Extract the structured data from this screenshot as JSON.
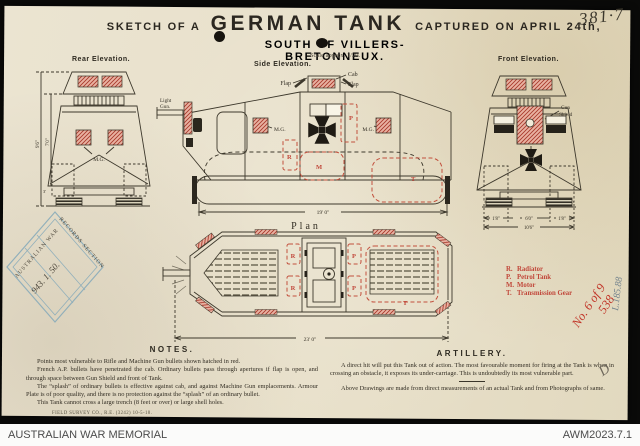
{
  "title": {
    "prefix": "SKETCH OF A",
    "main": "GERMAN TANK",
    "suffix": "CAPTURED ON APRIL 24th,",
    "line2": "SOUTH OF VILLERS-BRETONNEUX.",
    "scale": "Scale approx. 1/20."
  },
  "handwriting": {
    "top_right_number": "381·7",
    "blue_vertical": "L.185.88",
    "red_script_line1": "No. 6 of 9",
    "red_script_line2": "538",
    "pencil_letter": "D"
  },
  "stamp": {
    "arc_top": "AUSTRALIAN WAR",
    "arc_bottom": "RECORDS SECTION",
    "number": "943. 1. 50."
  },
  "rear": {
    "label": "Rear Elevation.",
    "mg": "M.G.",
    "dim_overall": "9'6\"",
    "dim_body": "7'0\"",
    "dim_bottom": "3'"
  },
  "side": {
    "label": "Side Elevation.",
    "cab": "Cab",
    "flap_left": "Flap",
    "flap_right": "Flap",
    "light_gun_1": "Light",
    "light_gun_2": "Gun.",
    "mg_left": "M.G.",
    "mg_right": "M.G.",
    "p": "P",
    "r": "R",
    "m": "M",
    "t": "T",
    "dim_length": "19' 0\""
  },
  "front": {
    "label": "Front Elevation.",
    "gun_shield_1": "Gun",
    "gun_shield_2": "Shield",
    "dim_left": "1'8\"",
    "dim_mid": "6'0\"",
    "dim_right": "1'8\"",
    "dim_total": "10'6\""
  },
  "plan": {
    "label": "Plan",
    "r1": "R",
    "r2": "R",
    "p1": "P",
    "p2": "P",
    "t": "T",
    "dim_length": "23' 0\""
  },
  "legend": {
    "items": [
      {
        "key": "R.",
        "label": "Radiator"
      },
      {
        "key": "P.",
        "label": "Petrol Tank"
      },
      {
        "key": "M.",
        "label": "Motor"
      },
      {
        "key": "T.",
        "label": "Transmission Gear"
      }
    ]
  },
  "notes": {
    "title": "NOTES.",
    "p1": "Points most vulnerable to Rifle and Machine Gun bullets shown hatched in red.",
    "p2": "French A.P. bullets have penetrated the cab.  Ordinary bullets pass through apertures if flap is open, and through space between Gun Shield and front of Tank.",
    "p3": "The “splash” of ordinary bullets is effective against cab, and against Machine Gun emplacements.  Armour Plate is of poor quality, and there is no protection against the “splash” of an ordinary bullet.",
    "p4": "This Tank cannot cross a large trench (8 feet or over) or large shell holes.",
    "imprint": "FIELD SURVEY CO., R.E. (3242) 10-5-18."
  },
  "artillery": {
    "title": "ARTILLERY.",
    "p1": "A direct hit will put this Tank out of action.  The most favourable moment for firing at the Tank is when in crossing an obstacle, it exposes its under-carriage.  This is undoubtedly its most vulnerable part.",
    "p2": "Above Drawings are made from direct measurements of an actual Tank and from Photographs of same."
  },
  "footer": {
    "left": "AUSTRALIAN WAR MEMORIAL",
    "right": "AWM2023.7.1"
  }
}
